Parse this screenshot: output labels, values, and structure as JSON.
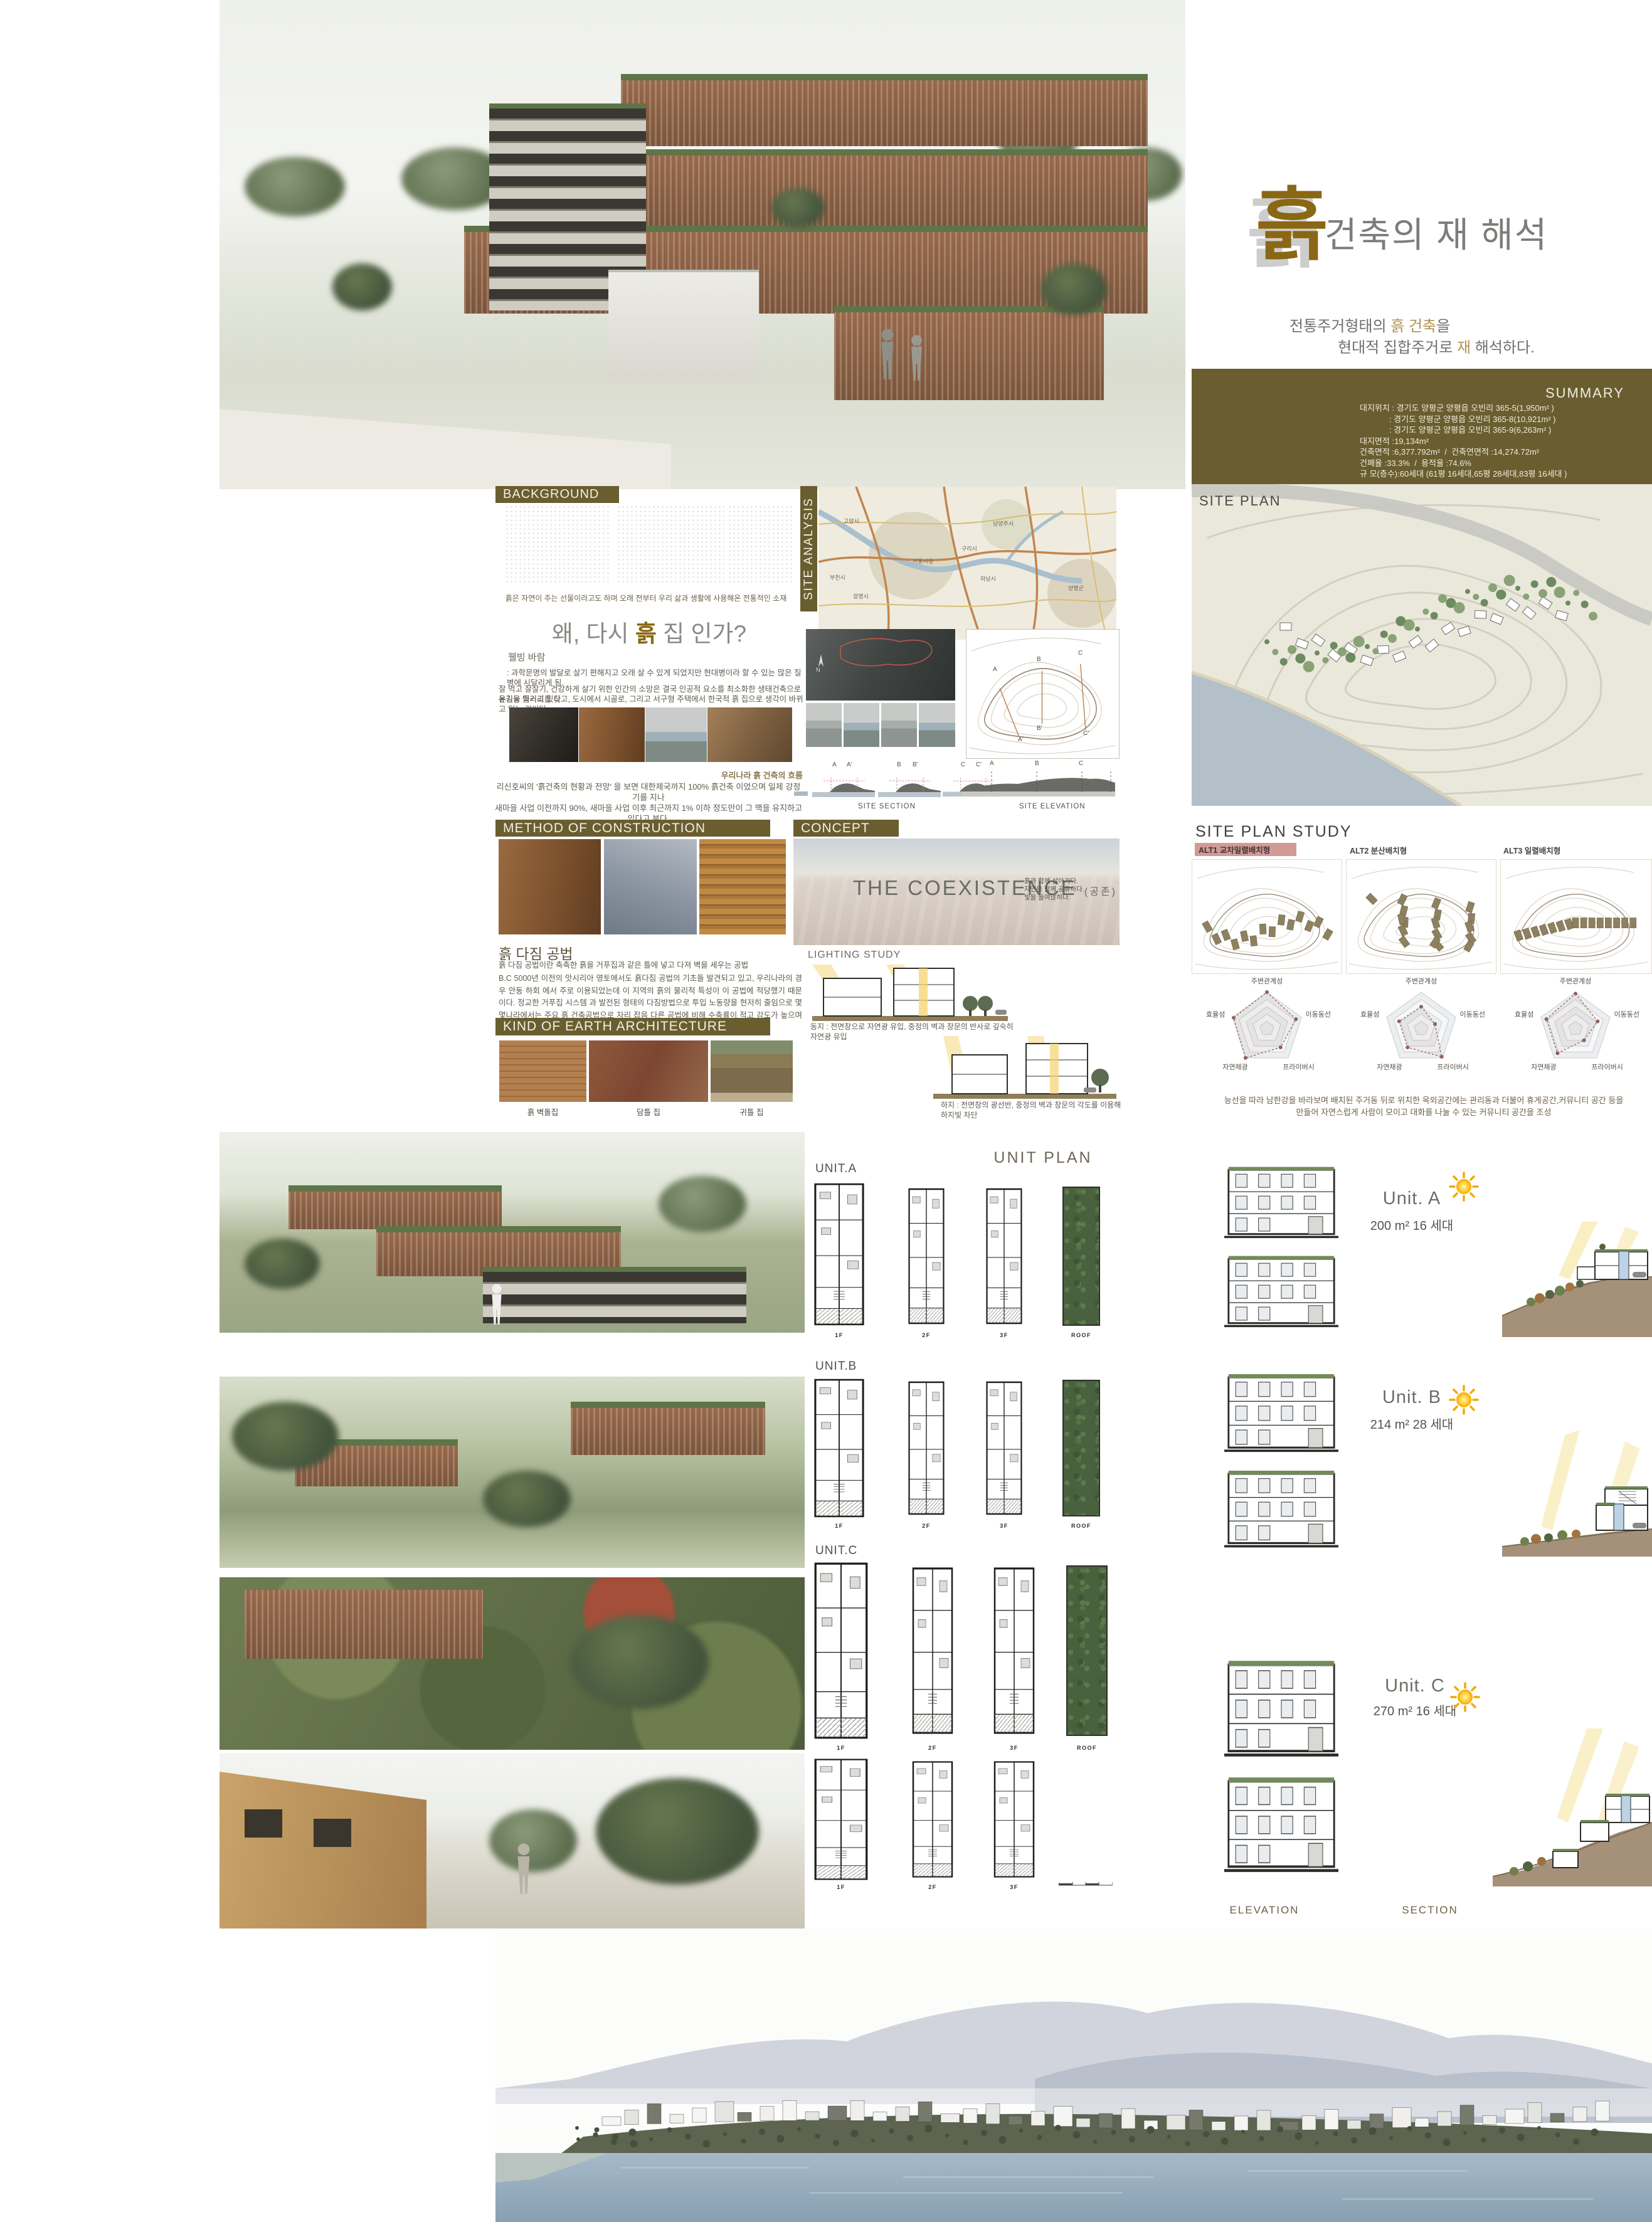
{
  "colors": {
    "olive": "#6a5e30",
    "title_brown": "#8a6714",
    "accent_tan": "#b09356",
    "grey_title": "#7c7c79",
    "pink_chip": "#d29a95",
    "radar_line": "#9c6f66",
    "hill": "#a5917a",
    "water": "#9db0bf"
  },
  "title": {
    "logo_char": "흙",
    "heading": "건축의 재 해석",
    "sub1_pre": "전통주거형태의 ",
    "sub1_accent": "흙 건축",
    "sub1_post": "을",
    "sub2_pre": "현대적 집합주거로 ",
    "sub2_accent": "재",
    "sub2_post": " 해석하다."
  },
  "summary": {
    "heading": "SUMMARY",
    "lines": [
      "대지위치 : 경기도 양평군 양평읍 오빈리 365-5(1,950m² )",
      "             : 경기도 양평군 양평읍 오빈리 365-8(10,921m² )",
      "             : 경기도 양평군 양평읍 오빈리 365-9(6,263m² )",
      "대지면적 :19,134m²",
      "건축면적 :6,377.792m²  /  건축연면적 :14,274.72m²",
      "건폐율 :33.3%  /  용적율 :74.6%",
      "규 모(층수):60세대 (61평 16세대,65평 28세대,83평 16세대 )"
    ]
  },
  "site_plan": {
    "label": "SITE PLAN"
  },
  "background": {
    "header": "BACKGROUND",
    "caption": "흙은 자연이 주는 선물이라고도 하며  오래 전부터 우리 삶과 생활에 사용해온 전통적인 소재"
  },
  "site_analysis": {
    "label": "SITE ANALYSIS",
    "compass": "N",
    "section_pairs": [
      [
        "A",
        "A'"
      ],
      [
        "B",
        "B'"
      ],
      [
        "C",
        "C'"
      ]
    ],
    "elevation_letters": [
      "A",
      "B",
      "C"
    ],
    "site_section": "SITE SECTION",
    "site_elevation": "SITE ELEVATION"
  },
  "map": {
    "labels": [
      "고양시",
      "서울시청",
      "구리시",
      "남양주시",
      "하남시",
      "부천시",
      "광명시",
      "양평군"
    ]
  },
  "why": {
    "heading_pre": "왜, 다시 ",
    "heading_accent": "흙",
    "heading_post": " 집 인가?",
    "wellbeing_title": "웰빙 바람",
    "p1": ": 과학문명의 발달로 살기 편해지고 오래 살 수 있게 되었지만 현대병이라 할 수 있는 많은  질병에 시달리게 됨.",
    "p2": "잘 먹고 잘살기, 건강하게 살기 위한 인간의 소망은 결국 인공적 요소를 최소화한 생태건축으로 눈길을 돌리고 있다.",
    "p3": "유기농 먹거리를 찾고, 도시에서 시골로, 그리고 서구형 주택에서 한국적 흙 집으로 생각이 바뀌고 있는 것이다.",
    "flow_title": "우리나라 흙 건축의 흐름",
    "flow_line1": "리신호씨의  '흙건축의 현황과 전망' 을 보면 대한제국까지 100% 흙건축 이었으며 일제 강정기를 지나",
    "flow_line2": "새마을 사업 이전까지 90%, 새마을 사업 이후 최근까지 1% 이하 정도만이 그 맥을 유지하고 있다고 본다."
  },
  "method": {
    "header": "METHOD OF CONSTRUCTION",
    "title": "흙 다짐 공법",
    "p1": "흙 다짐 공법이란 축축한 흙을 거푸집과 같은 틀에 넣고 다져 벽을 세우는 공법",
    "p2": "B.C 5000년 이전의 앗시리아 영토에서도 흙다짐 공법의 기초들 발견되고 있고, 우리나라의 경우 안동 하회 에서 주로 이용되었는데 이 지역의 흙의 물리적 특성이 이 공법에 적당했기 때문이다. 정교한 거푸집 시스템 과 발전된 형태의 다짐방법으로 투입 노동량을 현저히 줄임으로 몇몇나라에서는 주요 흙 건축공법으로 자리 잡음 다른 공법에 비해 수축률이 적고 강도가 높으며 일체식으로 이루어져 수명이 긴 것이 이 공법의 장점."
  },
  "kinds": {
    "header": "KIND OF EARTH ARCHITECTURE",
    "captions": [
      "흙 벽돌집",
      "담틀 집",
      "귀틀 집"
    ]
  },
  "concept": {
    "header": "CONCEPT",
    "title": "THE COEXISTENCE",
    "paren": "(공존)",
    "lines": [
      "흙과 함께 살아가다.",
      "자연을 함께 공유하다.",
      "빛을 들여앉히다."
    ]
  },
  "lighting": {
    "label": "LIGHTING STUDY",
    "winter": "동지 : 전면창으로 자연광 유입, 중정의 벽과 창문의 반사로 깊숙히 자연광 유입",
    "summer": "하지 : 전면창의 광선반, 중정의 벽과 창문의 각도를 이용해 하지빛 차단"
  },
  "site_plan_study": {
    "header": "SITE PLAN STUDY",
    "alts": [
      "ALT1  교차일렬배치형",
      "ALT2  분산배치형",
      "ALT3  일렬배치형"
    ],
    "radar_axes": [
      "주변관계성",
      "이동동선",
      "프라이버시",
      "자연채광",
      "효율성"
    ],
    "radar": [
      {
        "name": "ALT1",
        "values": [
          5,
          4.2,
          3.2,
          5,
          4.8
        ]
      },
      {
        "name": "ALT2",
        "values": [
          3,
          2,
          4.8,
          3.2,
          3.2
        ]
      },
      {
        "name": "ALT3",
        "values": [
          4.8,
          3.2,
          2,
          4.2,
          4.2
        ]
      }
    ],
    "note1": "능선을 따라 남한강을 바라보며 배치된 주거동 뒤로 위치한 옥외공간에는 관리동과 더불어 휴게공간,커뮤니티 공간 등을",
    "note2": "만들어  자연스럽게 사람이 모이고 대화를 나눌 수 있는 커뮤니티 공간을 조성"
  },
  "unit_plan": {
    "header": "UNIT PLAN",
    "floor_labels": [
      "1F",
      "2F",
      "3F",
      "ROOF"
    ],
    "units": {
      "a": {
        "plan_label": "UNIT.A",
        "name": "Unit. A",
        "area": "200 m²  16 세대"
      },
      "b": {
        "plan_label": "UNIT.B",
        "name": "Unit. B",
        "area": "214 m²  28 세대"
      },
      "c": {
        "plan_label": "UNIT.C",
        "name": "Unit. C",
        "area": "270 m²  16 세대"
      }
    }
  },
  "footer": {
    "elevation": "ELEVATION",
    "section": "SECTION"
  }
}
